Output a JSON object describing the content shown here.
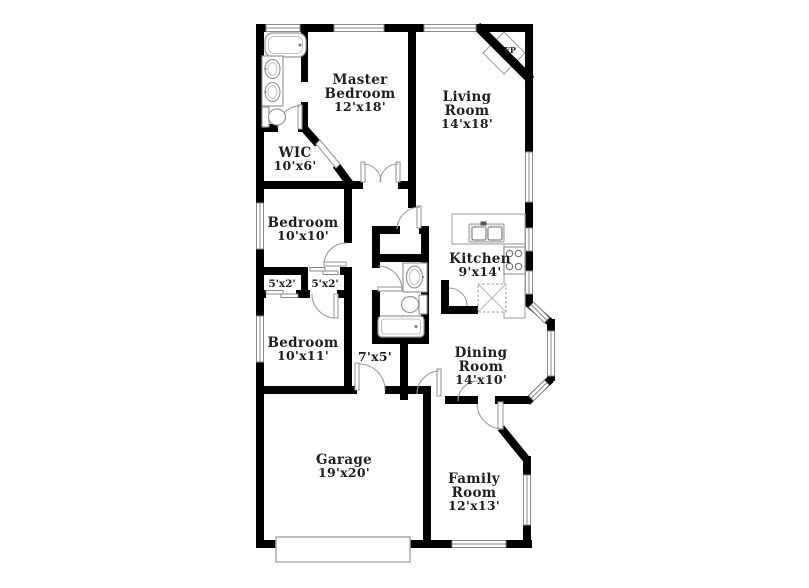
{
  "colors": {
    "wall": "#000000",
    "fixture_outline": "#999999",
    "label_text": "#1f1f1f",
    "background": "#ffffff"
  },
  "rooms": {
    "master_bedroom": {
      "line1": "Master",
      "line2": "Bedroom",
      "size": "12'x18'"
    },
    "living_room": {
      "line1": "Living",
      "line2": "Room",
      "size": "14'x18'"
    },
    "wic": {
      "line1": "WIC",
      "size": "10'x6'"
    },
    "bedroom_10x10": {
      "line1": "Bedroom",
      "size": "10'x10'"
    },
    "kitchen": {
      "line1": "Kitchen",
      "size": "9'x14'"
    },
    "closet_left": {
      "size": "5'x2'"
    },
    "closet_right": {
      "size": "5'x2'"
    },
    "bedroom_10x11": {
      "line1": "Bedroom",
      "size": "10'x11'"
    },
    "hall": {
      "size": "7'x5'"
    },
    "dining_room": {
      "line1": "Dining",
      "line2": "Room",
      "size": "14'x10'"
    },
    "garage": {
      "line1": "Garage",
      "size": "19'x20'"
    },
    "family_room": {
      "line1": "Family",
      "line2": "Room",
      "size": "12'x13'"
    },
    "fireplace": {
      "abbr": "FP"
    }
  }
}
